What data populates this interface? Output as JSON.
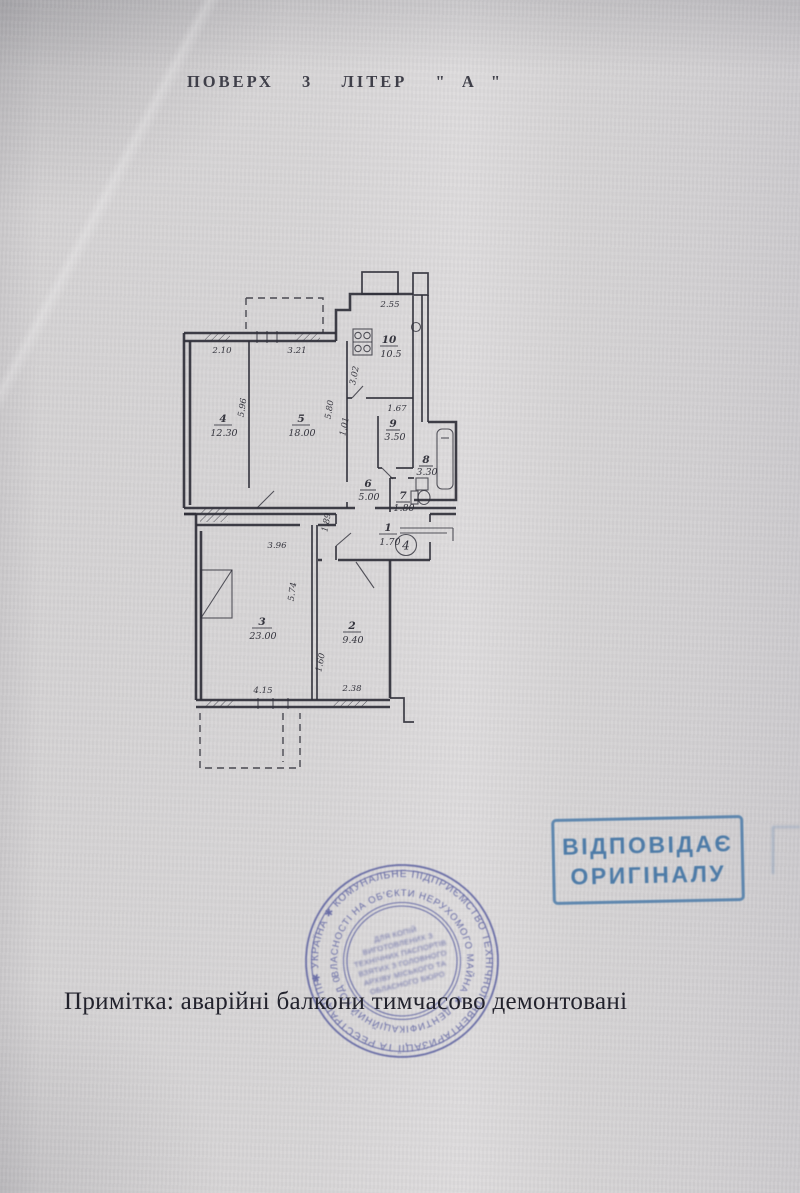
{
  "header": {
    "title": "ПОВЕРХ  3  ЛІТЕР  \" А \""
  },
  "plan": {
    "apartment_number": "4",
    "rooms": [
      {
        "number": "1",
        "area": "1.70"
      },
      {
        "number": "2",
        "area": "9.40"
      },
      {
        "number": "3",
        "area": "23.00"
      },
      {
        "number": "4",
        "area": "12.30"
      },
      {
        "number": "5",
        "area": "18.00"
      },
      {
        "number": "6",
        "area": "5.00"
      },
      {
        "number": "7",
        "area": "1.80"
      },
      {
        "number": "8",
        "area": "3.30"
      },
      {
        "number": "9",
        "area": "3.50"
      },
      {
        "number": "10",
        "area": "10.5"
      }
    ],
    "dims": {
      "room4_top": "2.10",
      "room5_top": "3.21",
      "kitchen_top": "2.55",
      "room9_top": "1.67",
      "room3_top": "3.96",
      "room3_bottom": "4.15",
      "room2_bottom": "2.38",
      "room4_h": "5.96",
      "room5_h": "5.80",
      "corridor_w": "1.01",
      "kitchen_l": "3.02",
      "hall_h": "1.89",
      "room3_h": "5.74",
      "room2_l": "1.60"
    }
  },
  "stamps": {
    "rect": {
      "line1": "ВІДПОВІДАЄ",
      "line2": "ОРИГІНАЛУ"
    },
    "round": {
      "ring_outer": "✱ УКРАЇНА ✱ КОМУНАЛЬНЕ ПІДПРИЄМСТВО ТЕХНІЧНОЇ ІНВЕНТАРИЗАЦІЇ ТА РЕЄСТРАЦІЇ ПРАВ",
      "ring_inner": "ВЛАСНОСТІ НА ОБ'ЄКТИ НЕРУХОМОГО МАЙНА ✱ ІДЕНТИФІКАЦІЙНИЙ КОД 03359336",
      "center_lines": [
        "ДЛЯ КОПІЙ",
        "ВИГОТОВЛЕНИХ З",
        "ТЕХНІЧНИХ ПАСПОРТІВ",
        "ВЗЯТИХ З ГОЛОВНОГО",
        "АРХІВУ МІСЬКОГО ТА",
        "ОБЛАСНОГО БЮРО"
      ]
    }
  },
  "note": {
    "text": "Примітка: аварійні балкони тимчасово демонтовані"
  }
}
